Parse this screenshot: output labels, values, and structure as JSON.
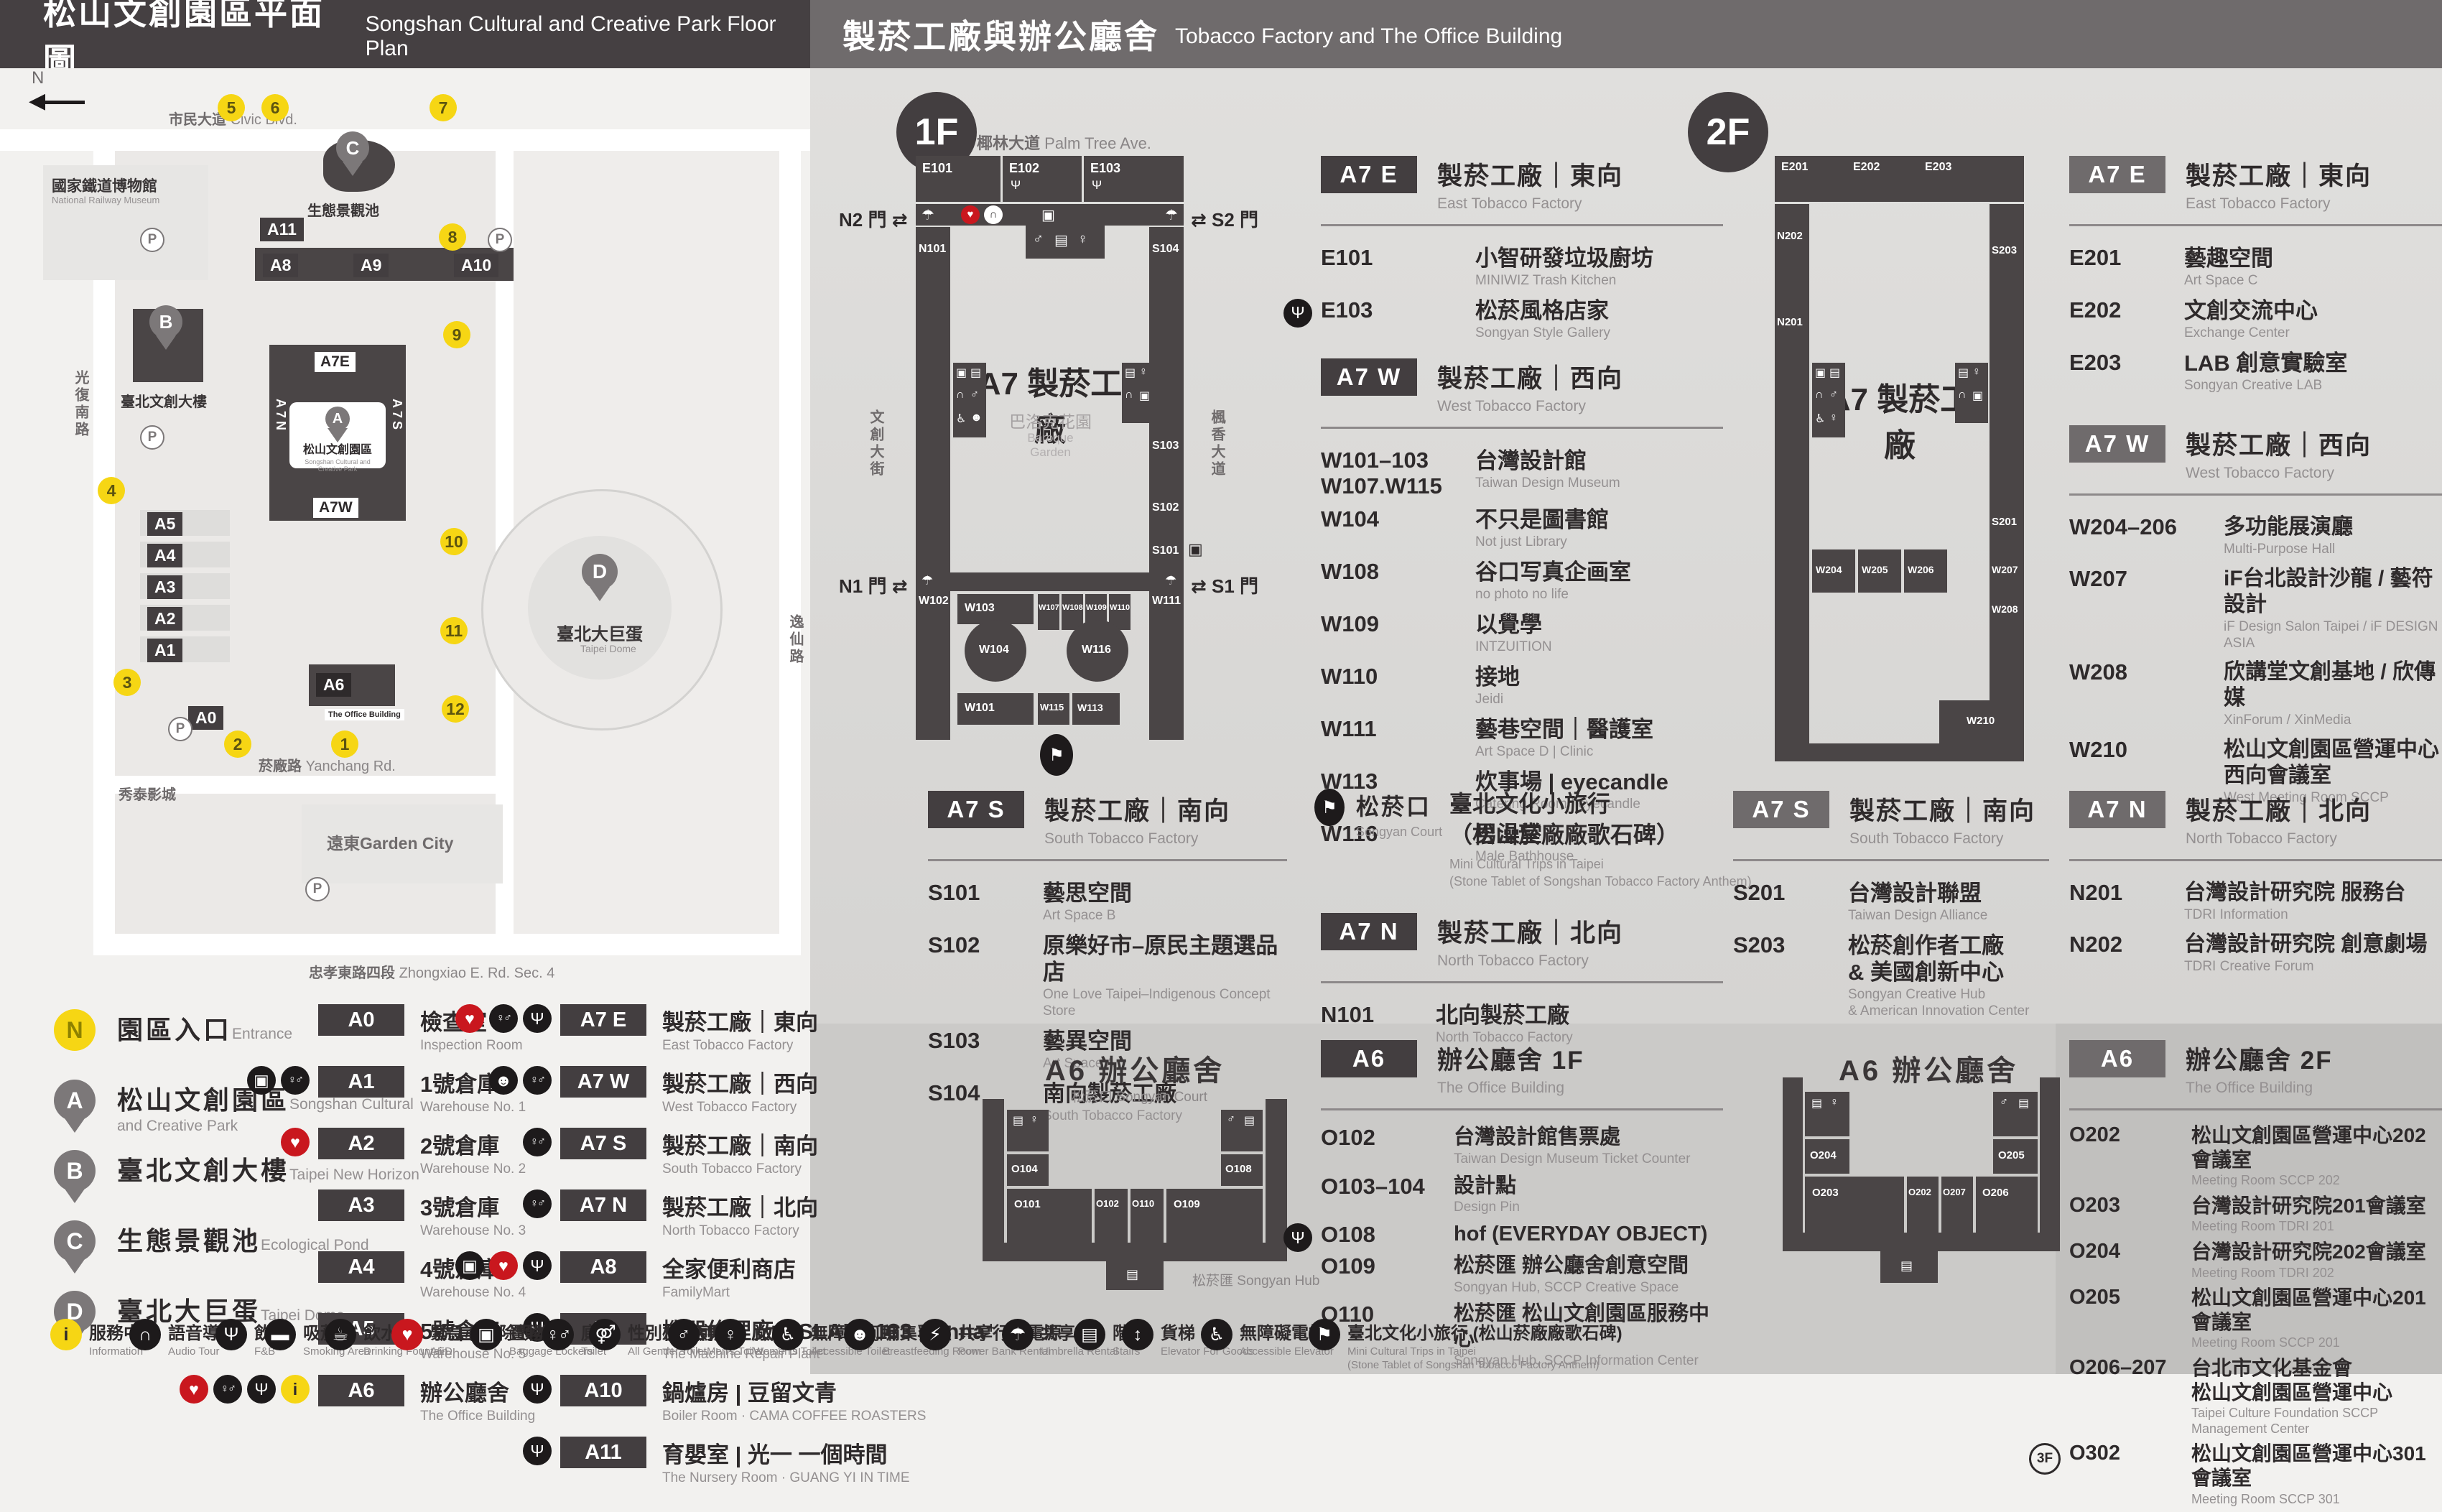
{
  "icon_glyphs": {
    "restaurant": "Ψ",
    "aed": "♥",
    "audio": "∩",
    "locker": "▣",
    "stairs": "▤",
    "restroom": "♀♂",
    "men": "♂",
    "women": "♀",
    "accessible": "♿",
    "umbrella": "☂",
    "info": "i",
    "elevator": "↕",
    "goods_elevator": "↕",
    "power": "⚡",
    "fountain": "☕",
    "smoke": "▬",
    "nursing": "☻",
    "breastfeeding": "☻",
    "trips": "⚑",
    "all_gender": "⚤",
    "accessible_elevator": "♿"
  },
  "header": {
    "left_zh": "松山文創園區平面圖",
    "left_en": "Songshan Cultural and Creative Park Floor Plan",
    "right_zh": "製菸工廠與辦公廳舍",
    "right_en": "Tobacco Factory and The Office Building"
  },
  "park": {
    "north": "N",
    "streets": [
      {
        "zh": "市民大道",
        "en": "Civic Blvd."
      },
      {
        "zh": "光復南路",
        "en": "Guangfu S. Rd."
      },
      {
        "zh": "菸廠路",
        "en": "Yanchang Rd."
      },
      {
        "zh": "忠孝東路四段",
        "en": "Zhongxiao E. Rd. Sec. 4"
      },
      {
        "zh": "逸仙路",
        "en": "Yixian Rd."
      }
    ],
    "landmarks": {
      "railway_zh": "國家鐵道博物館",
      "railway_en": "National Railway Museum",
      "parkbox_zh": "松山文創園區",
      "parkbox_en": "Songshan Cultural and Creative Park",
      "dome_zh": "臺北大巨蛋",
      "dome_en": "Taipei Dome",
      "garden_city": "遠東Garden City",
      "cinema": "秀泰影城",
      "office_tag": "The Office Building",
      "pond_zh": "生態景觀池",
      "newhorizon_zh": "臺北文創大樓"
    },
    "pins": [
      "A",
      "B",
      "C",
      "D"
    ],
    "stops": [
      "1",
      "2",
      "3",
      "4",
      "5",
      "6",
      "7",
      "8",
      "9",
      "10",
      "11",
      "12"
    ],
    "tags": {
      "a0": "A0",
      "a1": "A1",
      "a2": "A2",
      "a3": "A3",
      "a4": "A4",
      "a5": "A5",
      "a6": "A6",
      "a7e": "A7E",
      "a7w": "A7W",
      "a7n": "A7N",
      "a7s": "A7S",
      "a8": "A8",
      "a9": "A9",
      "a10": "A10",
      "a11": "A11"
    },
    "parking": "P"
  },
  "floor1": {
    "badge": "1F",
    "map": {
      "street_top_zh": "椰林大道",
      "street_top_en": "Palm Tree Ave.",
      "street_left_zh": "文創大街",
      "street_left_en": "Cultural & Creative Blvd.",
      "street_right_zh": "楓香大道",
      "street_right_en": "Maple Tree Ave.",
      "gate_n2": "N2 門",
      "gate_s2": "S2 門",
      "gate_n1": "N1 門",
      "gate_s1": "S1 門",
      "center": "A7 製菸工廠",
      "garden_zh": "巴洛克花園",
      "garden_en": "Baroque\nGarden",
      "labels": {
        "e101": "E101",
        "e102": "E102",
        "e103": "E103",
        "n101": "N101",
        "s104": "S104",
        "s103": "S103",
        "s102": "S102",
        "s101": "S101",
        "w102": "W102",
        "w103": "W103",
        "w104": "W104",
        "w107": "W107",
        "w108": "W108",
        "w109": "W109",
        "w110": "W110",
        "w111": "W111",
        "w113": "W113",
        "w115": "W115",
        "w116": "W116",
        "w101": "W101"
      }
    },
    "a7e": {
      "tag": "A7 E",
      "zh": "製菸工廠｜東向",
      "en": "East Tobacco Factory",
      "rooms": [
        {
          "id": "E101",
          "zh": "小智研發垃圾廚坊",
          "en": "MINIWIZ Trash Kitchen"
        },
        {
          "id": "E103",
          "icon": "restaurant",
          "zh": "松菸風格店家",
          "en": "Songyan Style Gallery"
        }
      ]
    },
    "a7w": {
      "tag": "A7 W",
      "zh": "製菸工廠｜西向",
      "en": "West Tobacco Factory",
      "rooms": [
        {
          "id": "W101–103\nW107.W115",
          "zh": "台灣設計館",
          "en": "Taiwan Design Museum"
        },
        {
          "id": "W104",
          "zh": "不只是圖書館",
          "en": "Not just Library"
        },
        {
          "id": "W108",
          "zh": "谷口写真企画室",
          "en": "no photo no life"
        },
        {
          "id": "W109",
          "zh": "以覺學",
          "en": "INTZUITION"
        },
        {
          "id": "W110",
          "zh": "接地",
          "en": "Jeidi"
        },
        {
          "id": "W111",
          "zh": "藝巷空間｜醫護室",
          "en": "Art Space D | Clinic"
        },
        {
          "id": "W113",
          "zh": "炊事場 | eyecandle",
          "en": "Catering Room | eyecandle"
        },
        {
          "id": "W116",
          "zh": "男澡堂",
          "en": "Male Bathhouse"
        }
      ]
    },
    "a7s": {
      "tag": "A7 S",
      "zh": "製菸工廠｜南向",
      "en": "South Tobacco Factory",
      "rooms": [
        {
          "id": "S101",
          "zh": "藝思空間",
          "en": "Art Space B"
        },
        {
          "id": "S102",
          "zh": "原樂好市–原民主題選品店",
          "en": "One Love Taipei–Indigenous Concept Store"
        },
        {
          "id": "S103",
          "zh": "藝異空間",
          "en": "Art Space A"
        },
        {
          "id": "S104",
          "zh": "南向製菸工廠",
          "en": "South Tobacco Factory"
        }
      ]
    },
    "court": {
      "zh": "松菸口",
      "en": "Songyan Court",
      "title": "臺北文化小旅行\n（松山菸廠廠歌石碑）",
      "sub": "Mini Cultural Trips in Taipei\n(Stone Tablet of Songshan Tobacco Factory Anthem)"
    },
    "a7n": {
      "tag": "A7 N",
      "zh": "製菸工廠｜北向",
      "en": "North Tobacco Factory",
      "rooms": [
        {
          "id": "N101",
          "zh": "北向製菸工廠",
          "en": "North Tobacco Factory"
        }
      ]
    },
    "a6": {
      "tag": "A6",
      "zh": "辦公廳舍 1F",
      "en": "The Office Building",
      "map_title": "A6 辦公廳舍",
      "court": "松菸口 Songyan Court",
      "hub": "松菸匯 Songyan Hub",
      "map_labels": {
        "o104": "O104",
        "o108": "O108",
        "o101": "O101",
        "o102": "O102",
        "o110": "O110",
        "o109": "O109"
      },
      "rooms": [
        {
          "id": "O102",
          "zh": "台灣設計館售票處",
          "en": "Taiwan Design Museum Ticket Counter"
        },
        {
          "id": "O103–104",
          "zh": "設計點",
          "en": "Design Pin"
        },
        {
          "id": "O108",
          "icon": "restaurant",
          "zh": "hof (EVERYDAY OBJECT)",
          "en": ""
        },
        {
          "id": "O109",
          "zh": "松菸匯 辦公廳舍創意空間",
          "en": "Songyan Hub, SCCP Creative Space"
        },
        {
          "id": "O110",
          "zh": "松菸匯 松山文創園區服務中心",
          "en": "Songyan Hub, SCCP Information Center"
        }
      ]
    }
  },
  "floor2": {
    "badge": "2F",
    "map": {
      "center": "A7 製菸工廠",
      "labels": {
        "e201": "E201",
        "e202": "E202",
        "e203": "E203",
        "n202": "N202",
        "n201": "N201",
        "s203": "S203",
        "s201": "S201",
        "w204": "W204",
        "w205": "W205",
        "w206": "W206",
        "w207": "W207",
        "w208": "W208",
        "w210": "W210"
      }
    },
    "a7e": {
      "tag": "A7 E",
      "zh": "製菸工廠｜東向",
      "en": "East Tobacco Factory",
      "rooms": [
        {
          "id": "E201",
          "zh": "藝趣空間",
          "en": "Art Space C"
        },
        {
          "id": "E202",
          "zh": "文創交流中心",
          "en": "Exchange Center"
        },
        {
          "id": "E203",
          "zh": "LAB 創意實驗室",
          "en": "Songyan Creative LAB"
        }
      ]
    },
    "a7w": {
      "tag": "A7 W",
      "zh": "製菸工廠｜西向",
      "en": "West Tobacco Factory",
      "rooms": [
        {
          "id": "W204–206",
          "zh": "多功能展演廳",
          "en": "Multi-Purpose Hall"
        },
        {
          "id": "W207",
          "zh": "iF台北設計沙龍 / 藝符設計",
          "en": "iF Design Salon Taipei / iF DESIGN ASIA"
        },
        {
          "id": "W208",
          "zh": "欣講堂文創基地 / 欣傳媒",
          "en": "XinForum / XinMedia"
        },
        {
          "id": "W210",
          "zh": "松山文創園區營運中心\n西向會議室",
          "en": "West Meeting Room SCCP"
        }
      ]
    },
    "a7s": {
      "tag": "A7 S",
      "zh": "製菸工廠｜南向",
      "en": "South Tobacco Factory",
      "rooms": [
        {
          "id": "S201",
          "zh": "台灣設計聯盟",
          "en": "Taiwan Design Alliance"
        },
        {
          "id": "S203",
          "zh": "松菸創作者工廠\n& 美國創新中心",
          "en": "Songyan Creative Hub\n& American Innovation Center"
        }
      ]
    },
    "a7n": {
      "tag": "A7 N",
      "zh": "製菸工廠｜北向",
      "en": "North Tobacco Factory",
      "rooms": [
        {
          "id": "N201",
          "zh": "台灣設計研究院 服務台",
          "en": "TDRI Information"
        },
        {
          "id": "N202",
          "zh": "台灣設計研究院 創意劇場",
          "en": "TDRI Creative Forum"
        }
      ]
    },
    "a6": {
      "tag": "A6",
      "zh": "辦公廳舍 2F",
      "en": "The Office Building",
      "map_title": "A6 辦公廳舍",
      "map_labels": {
        "o204": "O204",
        "o205": "O205",
        "o203": "O203",
        "o202": "O202",
        "o207": "O207",
        "o206": "O206"
      },
      "rooms": [
        {
          "id": "O202",
          "zh": "松山文創園區營運中心202會議室",
          "en": "Meeting Room SCCP 202"
        },
        {
          "id": "O203",
          "zh": "台灣設計研究院201會議室",
          "en": "Meeting Room TDRI 201"
        },
        {
          "id": "O204",
          "zh": "台灣設計研究院202會議室",
          "en": "Meeting Room TDRI 202"
        },
        {
          "id": "O205",
          "zh": "松山文創園區營運中心201會議室",
          "en": "Meeting Room SCCP 201"
        },
        {
          "id": "O206–207",
          "zh": "台北市文化基金會\n松山文創園區營運中心",
          "en": "Taipei Culture Foundation SCCP Management Center"
        },
        {
          "id": "O302",
          "pre": "3F",
          "zh": "松山文創園區營運中心301會議室",
          "en": "Meeting Room SCCP 301"
        }
      ]
    }
  },
  "legend": {
    "places": [
      {
        "pin": "N",
        "cls": "pin ypin",
        "zh": "園區入口",
        "en": "Entrance"
      },
      {
        "pin": "A",
        "cls": "pin",
        "zh": "松山文創園區",
        "en": "Songshan Cultural\nand Creative Park"
      },
      {
        "pin": "B",
        "cls": "pin",
        "zh": "臺北文創大樓",
        "en": "Taipei New Horizon"
      },
      {
        "pin": "C",
        "cls": "pin",
        "zh": "生態景觀池",
        "en": "Ecological Pond"
      },
      {
        "pin": "D",
        "cls": "pin",
        "zh": "臺北大巨蛋",
        "en": "Taipei Dome"
      }
    ],
    "a_items": [
      {
        "tag": "A0",
        "zh": "檢查室",
        "en": "Inspection Room",
        "icons": []
      },
      {
        "tag": "A1",
        "zh": "1號倉庫",
        "en": "Warehouse No. 1",
        "icons": [
          "locker",
          "restroom"
        ]
      },
      {
        "tag": "A2",
        "zh": "2號倉庫",
        "en": "Warehouse No. 2",
        "icons": [
          "aed"
        ]
      },
      {
        "tag": "A3",
        "zh": "3號倉庫",
        "en": "Warehouse No. 3",
        "icons": []
      },
      {
        "tag": "A4",
        "zh": "4號倉庫",
        "en": "Warehouse No. 4",
        "icons": []
      },
      {
        "tag": "A5",
        "zh": "5號倉庫",
        "en": "Warehouse No. 5",
        "icons": []
      },
      {
        "tag": "A6",
        "zh": "辦公廳舍",
        "en": "The Office Building",
        "icons": [
          "aed",
          "restroom",
          "restaurant",
          "info"
        ]
      }
    ],
    "a7_items": [
      {
        "tag": "A7 E",
        "zh": "製菸工廠｜東向",
        "en": "East Tobacco Factory",
        "icons": [
          "aed",
          "restroom",
          "restaurant"
        ]
      },
      {
        "tag": "A7 W",
        "zh": "製菸工廠｜西向",
        "en": "West Tobacco Factory",
        "icons": [
          "nursing",
          "restroom"
        ]
      },
      {
        "tag": "A7 S",
        "zh": "製菸工廠｜南向",
        "en": "South Tobacco Factory",
        "icons": [
          "restroom"
        ]
      },
      {
        "tag": "A7 N",
        "zh": "製菸工廠｜北向",
        "en": "North Tobacco Factory",
        "icons": [
          "restroom"
        ]
      },
      {
        "tag": "A8",
        "zh": "全家便利商店",
        "en": "FamilyMart",
        "icons": [
          "locker",
          "aed",
          "restaurant"
        ]
      },
      {
        "tag": "A9",
        "zh": "機器修理廠 | ISLAND133 gonna⁺",
        "en": "The Machine Repair Plant",
        "icons": [
          "restaurant"
        ]
      },
      {
        "tag": "A10",
        "zh": "鍋爐房 | 豆留文青",
        "en": "Boiler Room · CAMA COFFEE ROASTERS",
        "icons": [
          "restaurant"
        ]
      },
      {
        "tag": "A11",
        "zh": "育嬰室 | 光一 一個時間",
        "en": "The Nursery Room · GUANG YI IN TIME",
        "icons": [
          "restaurant"
        ]
      }
    ]
  },
  "icon_strip": [
    {
      "icon": "info",
      "zh": "服務中心",
      "en": "Information"
    },
    {
      "icon": "audio",
      "zh": "語音導覽",
      "en": "Audio Tour"
    },
    {
      "icon": "restaurant",
      "zh": "飲食",
      "en": "F&B"
    },
    {
      "icon": "smoke",
      "zh": "吸菸區",
      "en": "Smoking Area"
    },
    {
      "icon": "fountain",
      "zh": "飲水機",
      "en": "Drinking Fountain"
    },
    {
      "icon": "aed",
      "zh": "緊急心臟除顫器",
      "en": "AED"
    },
    {
      "icon": "locker",
      "zh": "置物櫃",
      "en": "Baggage Lockers"
    },
    {
      "icon": "restroom",
      "zh": "廁所",
      "en": "Toilet"
    },
    {
      "icon": "all_gender",
      "zh": "性別友善廁所",
      "en": "All Gender Toilet"
    },
    {
      "icon": "men",
      "zh": "男廁",
      "en": "Men's Toilet"
    },
    {
      "icon": "women",
      "zh": "女廁",
      "en": "Women's Toilet"
    },
    {
      "icon": "accessible",
      "zh": "無障礙廁所",
      "en": "Accessible Toilet"
    },
    {
      "icon": "breastfeeding",
      "zh": "哺集乳室",
      "en": "Breastfeeding Room"
    },
    {
      "icon": "power",
      "zh": "共享行動電源",
      "en": "Power Bank Rental"
    },
    {
      "icon": "umbrella",
      "zh": "共享傘",
      "en": "Umbrella Rental"
    },
    {
      "icon": "stairs",
      "zh": "階梯",
      "en": "Stairs"
    },
    {
      "icon": "goods_elevator",
      "zh": "貨梯",
      "en": "Elevator For Goods"
    },
    {
      "icon": "accessible_elevator",
      "zh": "無障礙電梯",
      "en": "Accessible Elevator"
    },
    {
      "icon": "trips",
      "zh": "臺北文化小旅行 (松山菸廠廠歌石碑)",
      "en": "Mini Cultural Trips in Taipei\n(Stone Tablet of Songshan Tobacco Factory Anthem)"
    }
  ]
}
